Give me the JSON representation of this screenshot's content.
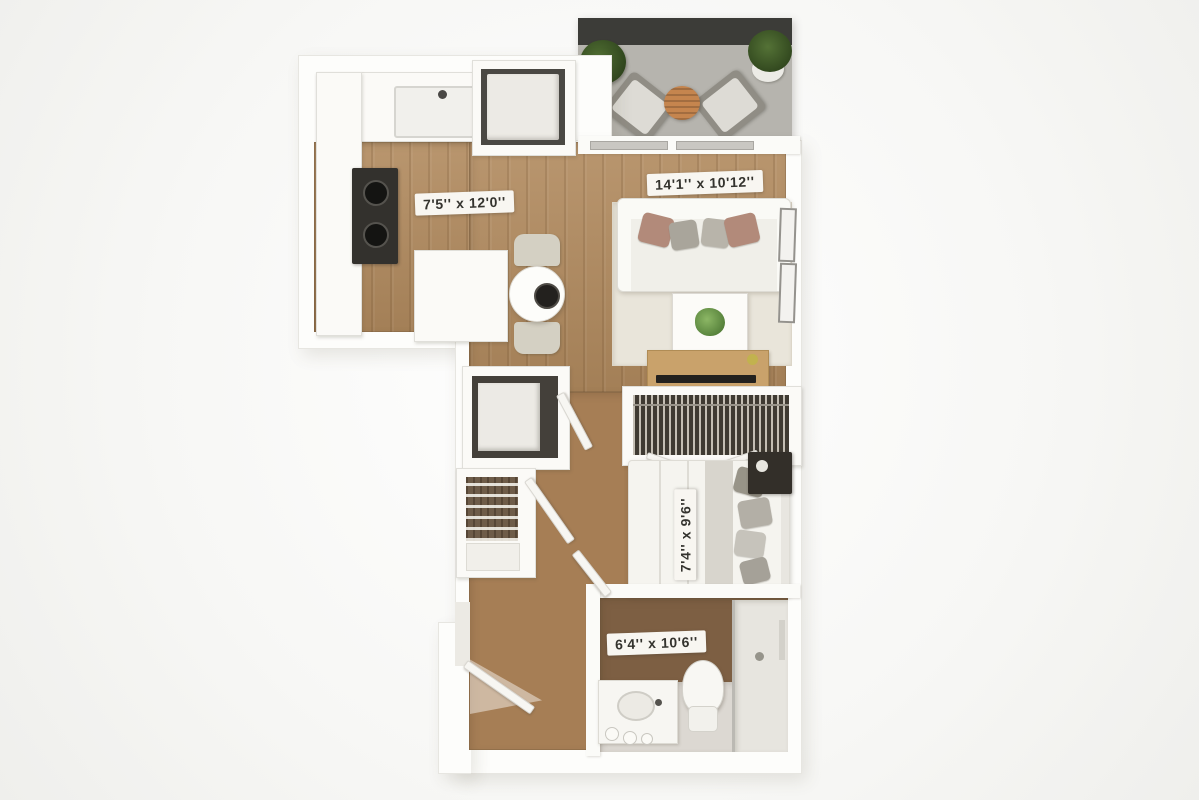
{
  "floorplan": {
    "type": "studio-apartment-3d-floor-plan",
    "rooms": {
      "kitchen": {
        "dimensions": "7'5'' x 12'0''"
      },
      "living_room": {
        "dimensions": "14'1'' x 10'12''"
      },
      "bedroom": {
        "dimensions": "7'4'' x 9'6''"
      },
      "bathroom": {
        "dimensions": "6'4'' x 10'6''"
      }
    },
    "colors": {
      "background": "#f7f7f5",
      "wall": "#fdfdfb",
      "wood_floor": "#b18a5e",
      "balcony_floor": "#b6b4ae",
      "balcony_railing": "#3c3c38",
      "bathroom_accent_floor": "#7d5f43",
      "label_bg": "#f8f6f1",
      "label_text": "#34332e",
      "tv_console_wood": "#c9a26b",
      "plant_green": "#55803a"
    },
    "fixtures": [
      "balcony-railing",
      "balcony-plant",
      "balcony-chair",
      "balcony-table",
      "kitchen-sink",
      "stove",
      "washer-closet",
      "kitchen-island",
      "dining-table",
      "dining-chair",
      "sofa",
      "coffee-table",
      "tv-console",
      "wall-frames",
      "wardrobe-closet",
      "bifold-door",
      "bed",
      "nightstand",
      "linen-closet",
      "storage-closet",
      "entry-door",
      "bathroom-door",
      "vanity-sink",
      "toilet",
      "shower"
    ]
  }
}
